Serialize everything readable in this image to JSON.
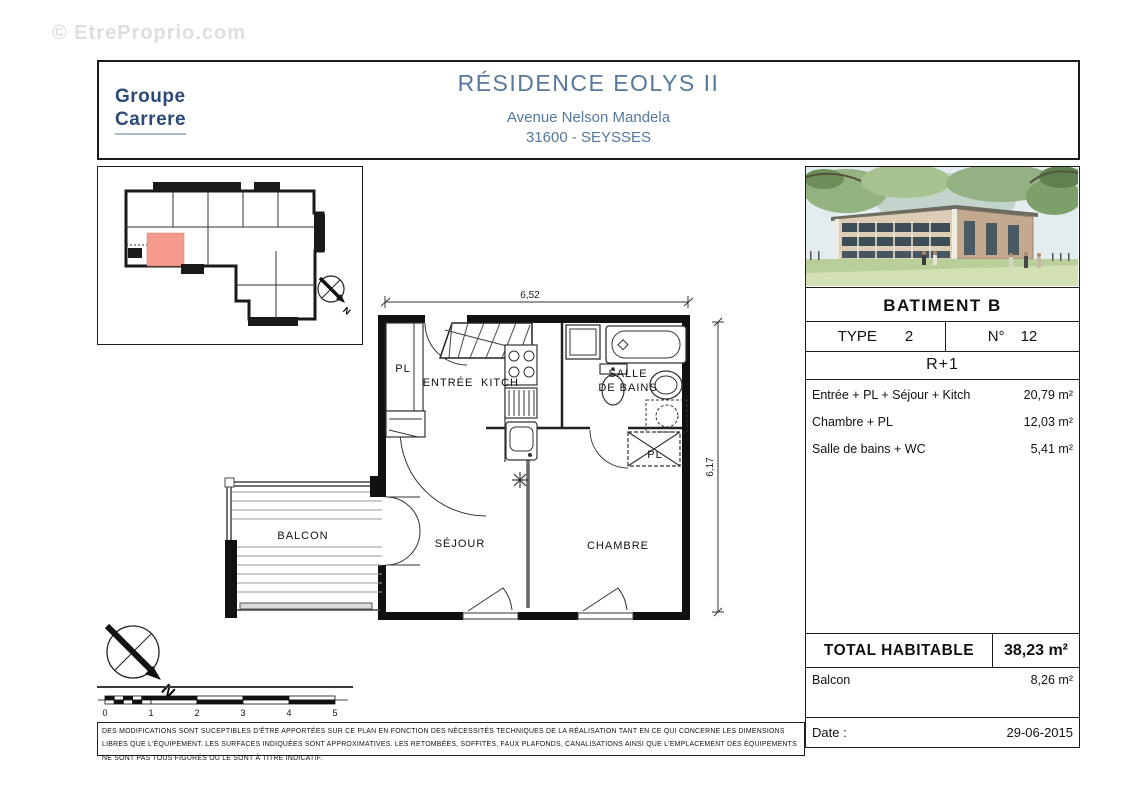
{
  "watermark": "© EtreProprio.com",
  "header": {
    "logo_line1": "Groupe",
    "logo_line2": "Carrere",
    "title": "RÉSIDENCE EOLYS II",
    "address_line1": "Avenue Nelson Mandela",
    "address_line2": "31600 - SEYSSES"
  },
  "plan": {
    "dim_width": "6,52",
    "dim_height": "6,17",
    "rooms": {
      "pl_entree": "PL",
      "entree": "ENTRÉE",
      "kitch": "KITCH",
      "sdb_line1": "SALLE",
      "sdb_line2": "DE BAINS",
      "balcon": "BALCON",
      "sejour": "SÉJOUR",
      "chambre": "CHAMBRE",
      "pl_chambre": "PL"
    }
  },
  "compass": {
    "north": "N"
  },
  "overview_compass": {
    "north": "N"
  },
  "scalebar": {
    "labels": [
      "0",
      "1",
      "2",
      "3",
      "4",
      "5"
    ]
  },
  "panel": {
    "batiment": "BATIMENT B",
    "type_label": "TYPE",
    "type_value": "2",
    "num_label": "N°",
    "num_value": "12",
    "floor": "R+1",
    "areas": [
      {
        "label": "Entrée + PL + Séjour + Kitch",
        "value": "20,79 m²"
      },
      {
        "label": "Chambre + PL",
        "value": "12,03 m²"
      },
      {
        "label": "Salle de bains + WC",
        "value": "5,41 m²"
      }
    ],
    "total_label": "TOTAL HABITABLE",
    "total_value": "38,23 m²",
    "balcon_label": "Balcon",
    "balcon_value": "8,26 m²",
    "date_label": "Date :",
    "date_value": "29-06-2015"
  },
  "footer": {
    "disclaimer": "DES MODIFICATIONS SONT SUCEPTIBLES D'ÊTRE APPORTÉES SUR CE PLAN EN FONCTION DES NÉCESSITÉS TECHNIQUES DE LA RÉALISATION TANT EN CE QUI CONCERNE LES DIMENSIONS LIBRES QUE L'ÉQUIPEMENT. LES SURFACES INDIQUÉES SONT APPROXIMATIVES. LES RETOMBÉES, SOFFITES, FAUX PLAFONDS, CANALISATIONS AINSI QUE L'EMPLACEMENT DES ÉQUIPEMENTS NE SONT PAS TOUS FIGURÉS OU LE SONT À TITRE INDICATIF."
  },
  "colors": {
    "accent_blue": "#55789e",
    "logo_navy": "#2b4a77",
    "highlight_salmon": "#f59a8c"
  }
}
